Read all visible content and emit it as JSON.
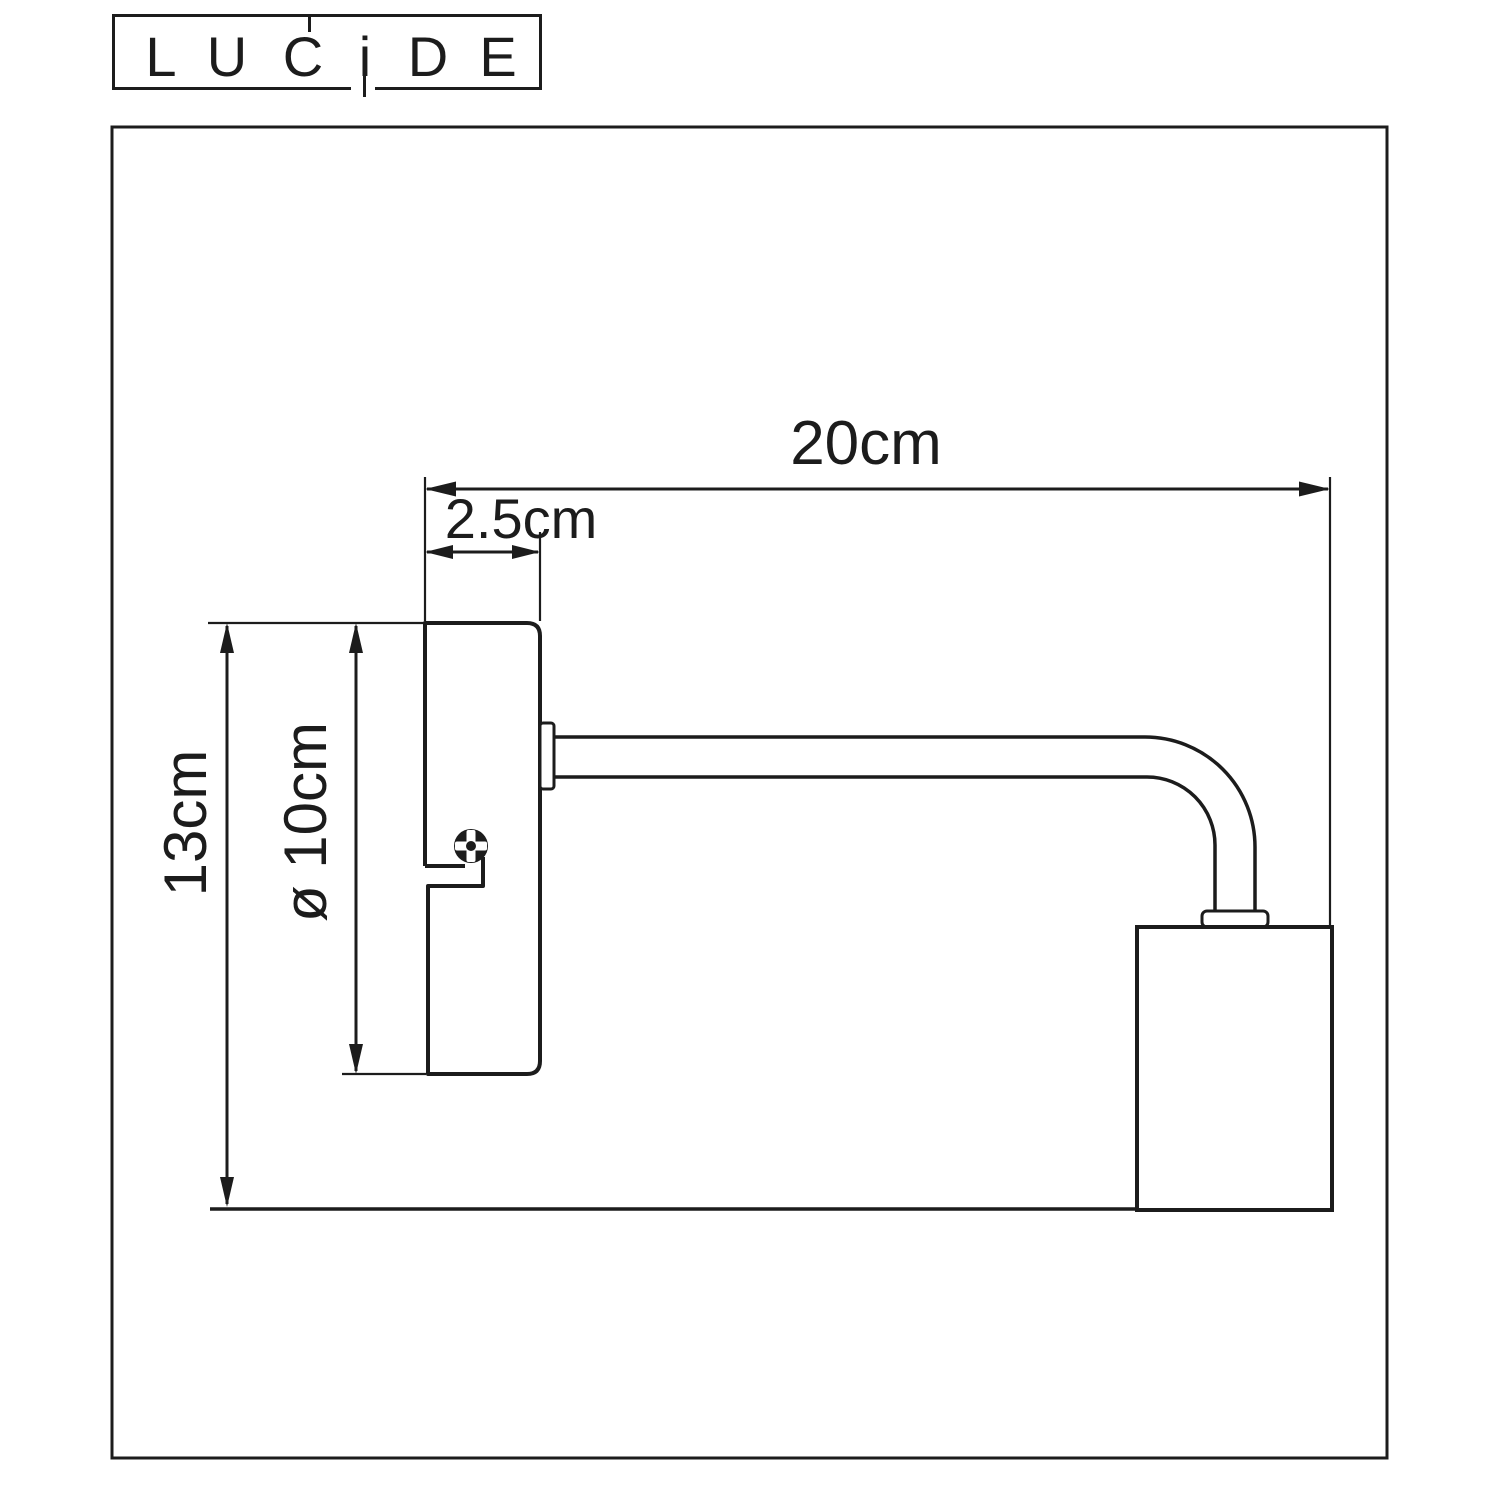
{
  "logo": {
    "letters": [
      "L",
      "U",
      "C",
      "i",
      "D",
      "E"
    ]
  },
  "dimensions": {
    "width_total": "20cm",
    "plate_depth": "2.5cm",
    "height_total": "13cm",
    "plate_diameter": "ø 10cm"
  },
  "footer": {
    "item_number_label": "Item number:",
    "item_numbers": "45265/01/30;  45265/01/31"
  },
  "colors": {
    "line": "#1c1c1c",
    "background": "#ffffff"
  }
}
